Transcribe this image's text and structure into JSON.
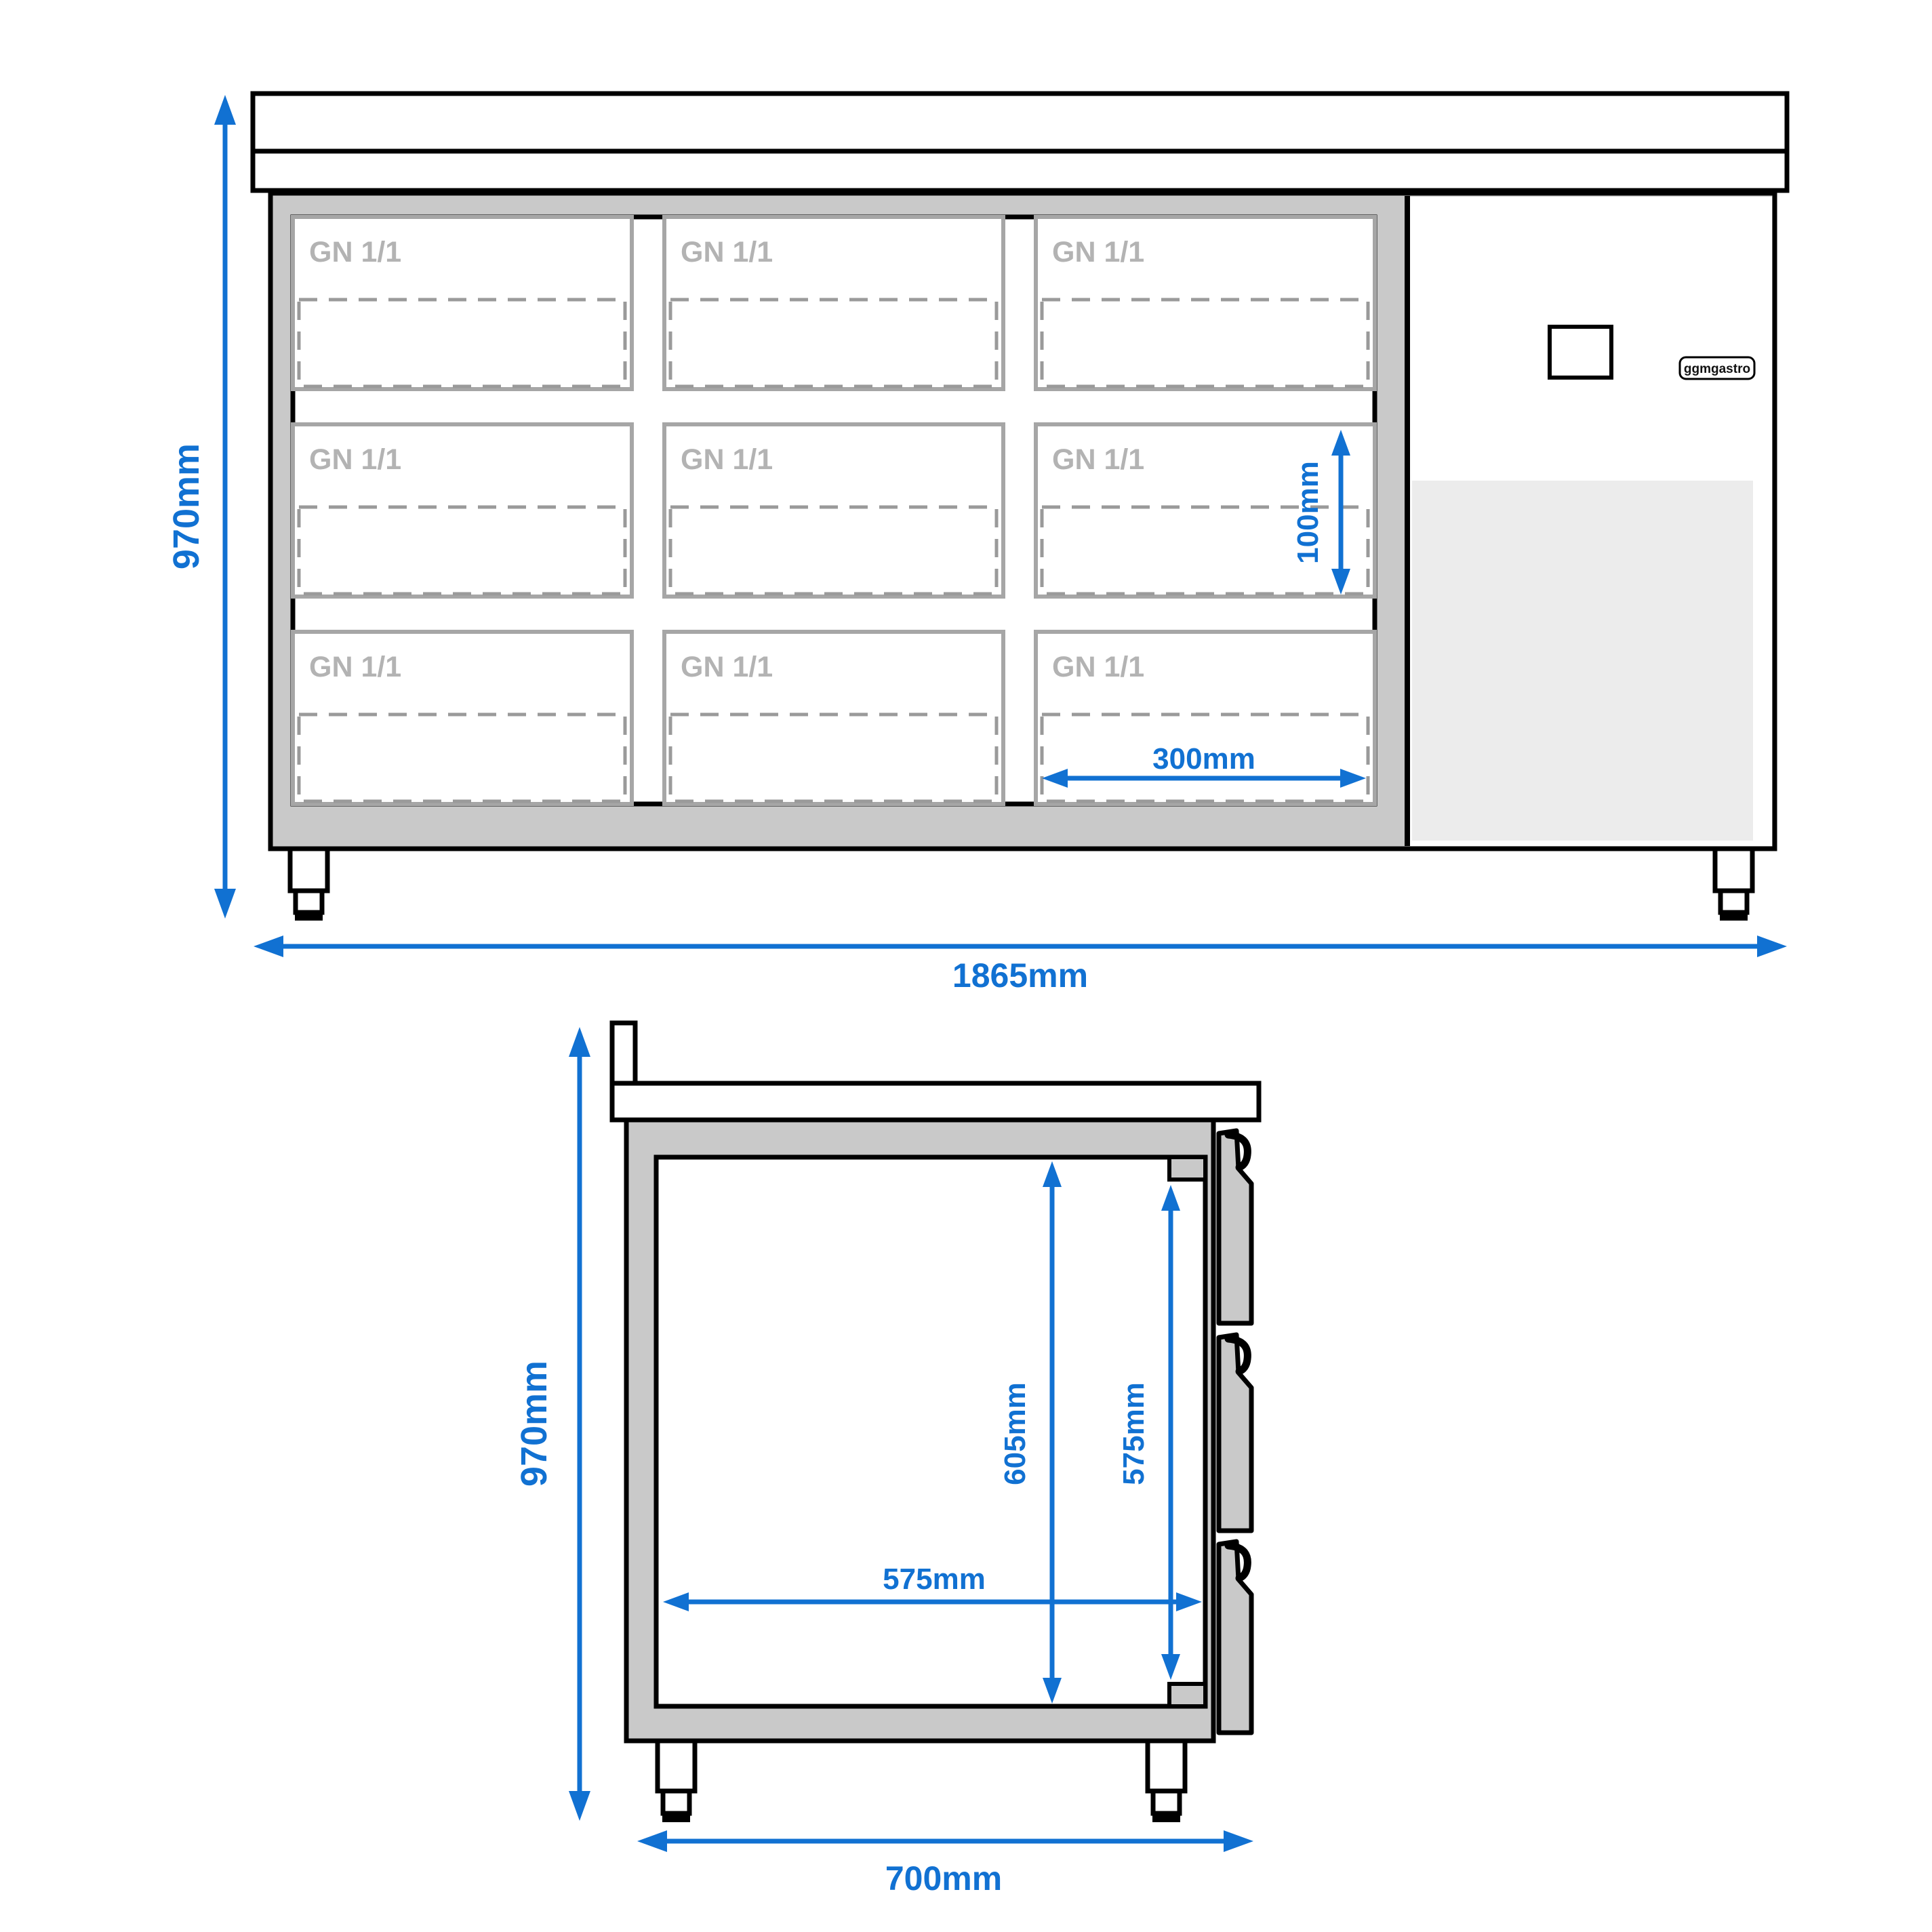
{
  "drawing": {
    "front_view": {
      "overall_height": "970mm",
      "overall_width": "1865mm",
      "pan_depth": "100mm",
      "pan_opening_width": "300mm",
      "logo": "ggmgastro",
      "gn_cells": [
        "GN 1/1",
        "GN 1/1",
        "GN 1/1",
        "GN 1/1",
        "GN 1/1",
        "GN 1/1",
        "GN 1/1",
        "GN 1/1",
        "GN 1/1"
      ]
    },
    "side_view": {
      "overall_height": "970mm",
      "overall_depth": "700mm",
      "interior_height": "605mm",
      "drawer_interior_height": "575mm",
      "interior_depth": "575mm"
    },
    "colors": {
      "dimension_blue": "#1171d2",
      "body_gray": "#c9c9c9",
      "grille_gray": "#ececec",
      "gn_label_gray": "#b3b3b3"
    }
  }
}
